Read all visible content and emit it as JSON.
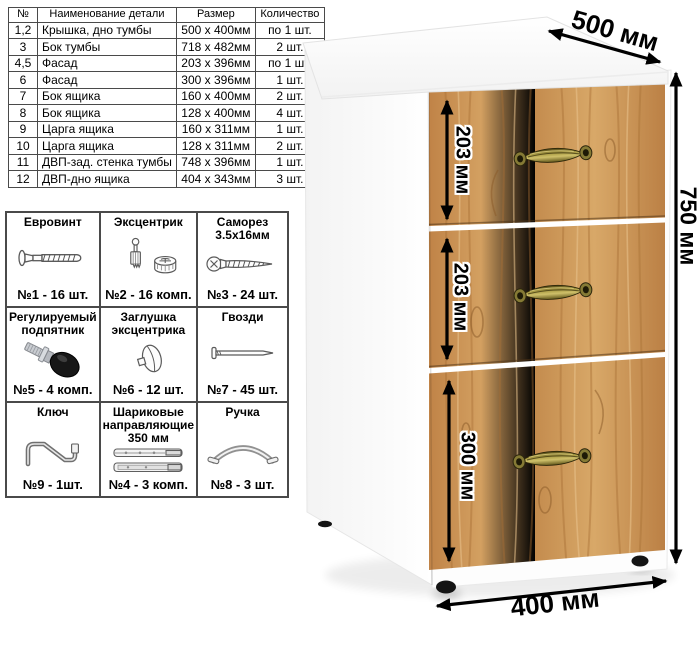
{
  "parts_table": {
    "headers": [
      "№",
      "Наименование детали",
      "Размер",
      "Количество"
    ],
    "rows": [
      [
        "1,2",
        "Крышка, дно тумбы",
        "500 х 400мм",
        "по 1 шт."
      ],
      [
        "3",
        "Бок тумбы",
        "718 х 482мм",
        "2 шт."
      ],
      [
        "4,5",
        "Фасад",
        "203 х 396мм",
        "по 1 шт."
      ],
      [
        "6",
        "Фасад",
        "300 х 396мм",
        "1 шт."
      ],
      [
        "7",
        "Бок ящика",
        "160 х 400мм",
        "2 шт."
      ],
      [
        "8",
        "Бок ящика",
        "128 х 400мм",
        "4 шт."
      ],
      [
        "9",
        "Царга ящика",
        "160 х 311мм",
        "1 шт."
      ],
      [
        "10",
        "Царга ящика",
        "128 х 311мм",
        "2 шт."
      ],
      [
        "11",
        "ДВП-зад. стенка тумбы",
        "748 х 396мм",
        "1 шт."
      ],
      [
        "12",
        "ДВП-дно ящика",
        "404 х 343мм",
        "3 шт."
      ]
    ]
  },
  "hardware": {
    "items": [
      {
        "title": "Евровинт",
        "count": "№1 - 16 шт.",
        "icon": "euro-screw-icon"
      },
      {
        "title": "Эксцентрик",
        "count": "№2 - 16 комп.",
        "icon": "cam-lock-icon"
      },
      {
        "title": "Саморез 3.5х16мм",
        "count": "№3 - 24 шт.",
        "icon": "self-tapping-screw-icon"
      },
      {
        "title": "Регулируемый подпятник",
        "count": "№5 - 4 комп.",
        "icon": "adjustable-foot-icon"
      },
      {
        "title": "Заглушка эксцентрика",
        "count": "№6 - 12 шт.",
        "icon": "cam-cover-icon"
      },
      {
        "title": "Гвозди",
        "count": "№7 - 45 шт.",
        "icon": "nail-icon"
      },
      {
        "title": "Ключ",
        "count": "№9 - 1шт.",
        "icon": "hex-key-icon"
      },
      {
        "title": "Шариковые направляющие 350 мм",
        "count": "№4 - 3 комп.",
        "icon": "drawer-slides-icon"
      },
      {
        "title": "Ручка",
        "count": "№8 - 3 шт.",
        "icon": "pull-handle-icon"
      }
    ]
  },
  "dimensions": {
    "top_depth": "500 мм",
    "height": "750 мм",
    "width": "400 мм",
    "drawer1": "203 мм",
    "drawer2": "203 мм",
    "drawer3": "300 мм"
  },
  "colors": {
    "wood_base": "#c9924f",
    "wood_grain_dark": "#a86f35",
    "handle_brass": "#8a7b35",
    "table_border": "#4a4a4a",
    "dimension_arrow": "#000000"
  }
}
